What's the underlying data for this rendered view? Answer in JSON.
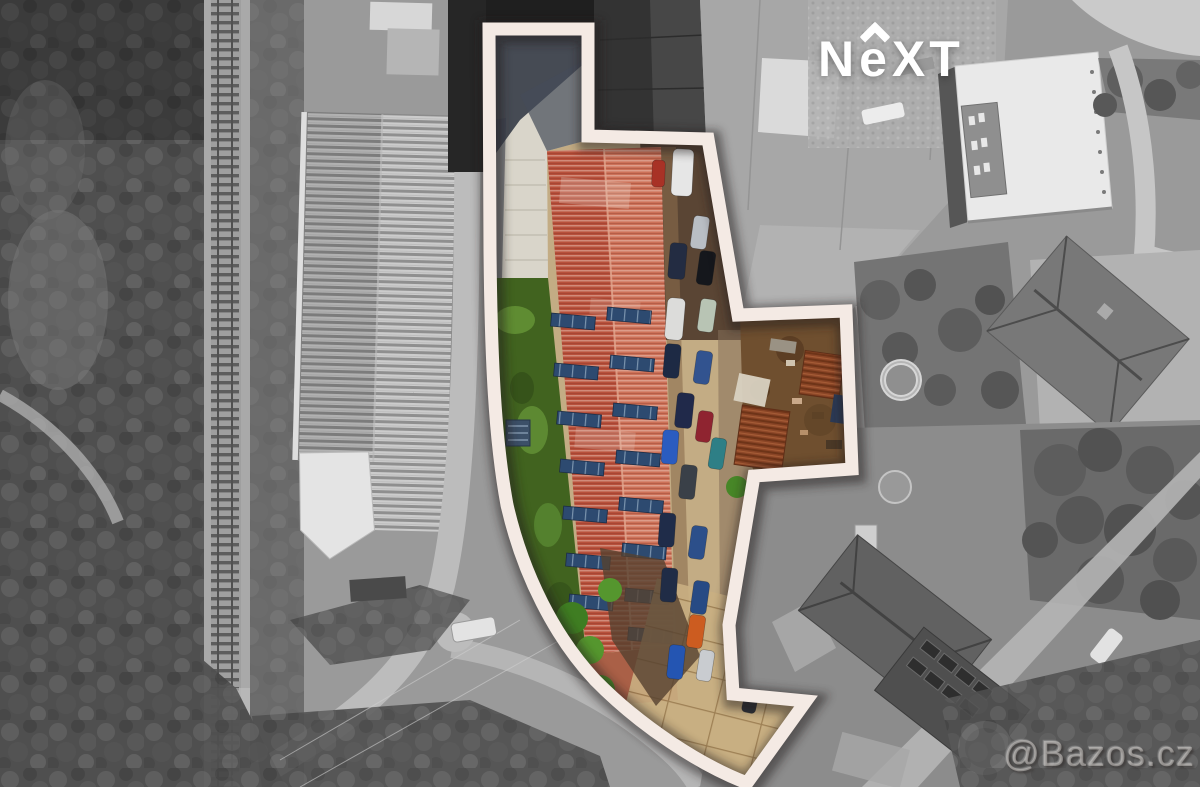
{
  "branding": {
    "logo": {
      "letter_n": "N",
      "letter_e": "e",
      "letters_xt": "XT",
      "color": "#ffffff"
    },
    "watermark": {
      "text": "@Bazos.cz"
    }
  },
  "palette": {
    "outline_stroke": "#f4eae4",
    "outline_shadow": "#201d1a",
    "roof_red_left": "#b8503b",
    "roof_red_right": "#cd7158",
    "solar_panel": "#2d4a70",
    "lawn": "#41631f",
    "pavement": "#c3ac84",
    "construction_dirt": "#6f4f2f",
    "rust_roof": "#8a4526",
    "road_gray": "#bdbdbd",
    "forest_gray": "#4f4f4f",
    "white_building": "#e9e9e9"
  }
}
